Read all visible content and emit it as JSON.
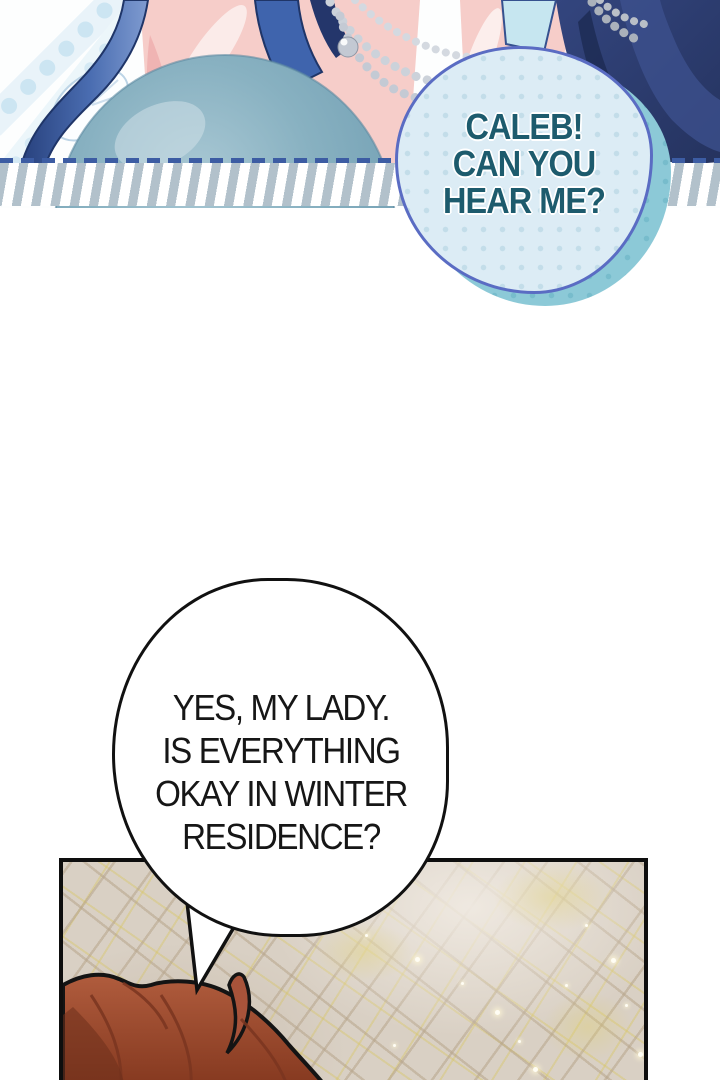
{
  "comic": {
    "bubble_caleb": {
      "lines": [
        "CALEB!",
        "CAN YOU",
        "HEAR ME?"
      ]
    },
    "bubble_reply": {
      "lines": [
        "YES, MY LADY.",
        "IS EVERYTHING",
        "OKAY IN WINTER",
        "RESIDENCE?"
      ]
    }
  },
  "colors": {
    "caleb_text": "#1d5b6d",
    "caleb_bubble_fill": "#dcecf5",
    "caleb_bubble_outer": "#8cc9d7",
    "caleb_bubble_outline": "#5a6cc3",
    "reply_text": "#161616",
    "reply_bubble_fill": "#ffffff",
    "reply_bubble_outline": "#111111",
    "crystal_ball": "#7fa9ba",
    "hair_blue": "#4a6db1",
    "fabric_navy": "#2b3a6b",
    "character_hair_red": "#a8533a",
    "cobblestone": "#d9d0c4",
    "stripe_band": "#b2c1cb",
    "dashed_line": "#3c5ca3"
  }
}
